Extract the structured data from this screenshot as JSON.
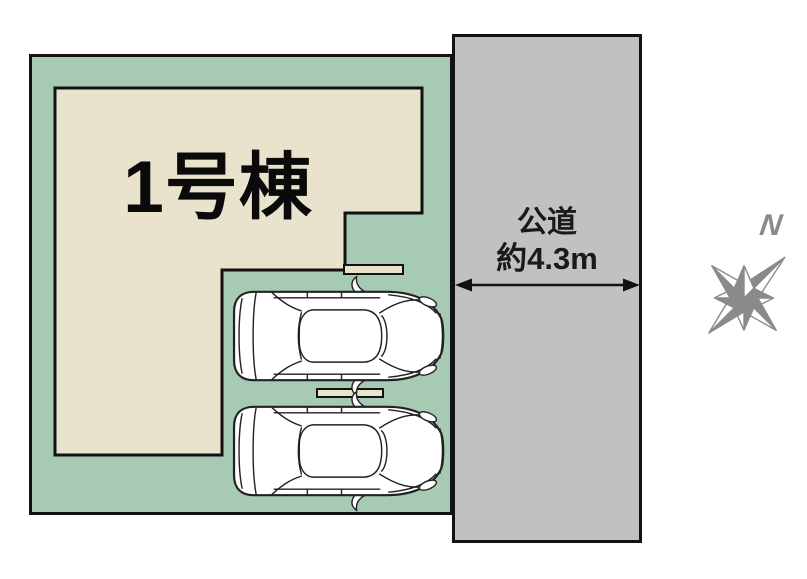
{
  "building": {
    "label": "1号棟"
  },
  "road": {
    "name_label": "公道",
    "width_label": "約4.3m"
  },
  "compass": {
    "north_label": "N"
  },
  "parking": {
    "car_count": 2
  },
  "colors": {
    "plot-green": "#a6cab4",
    "building-beige": "#e9e2cd",
    "road-gray": "#c1c1c1",
    "outline": "#121212",
    "compass-gray": "#8a8a8a"
  }
}
